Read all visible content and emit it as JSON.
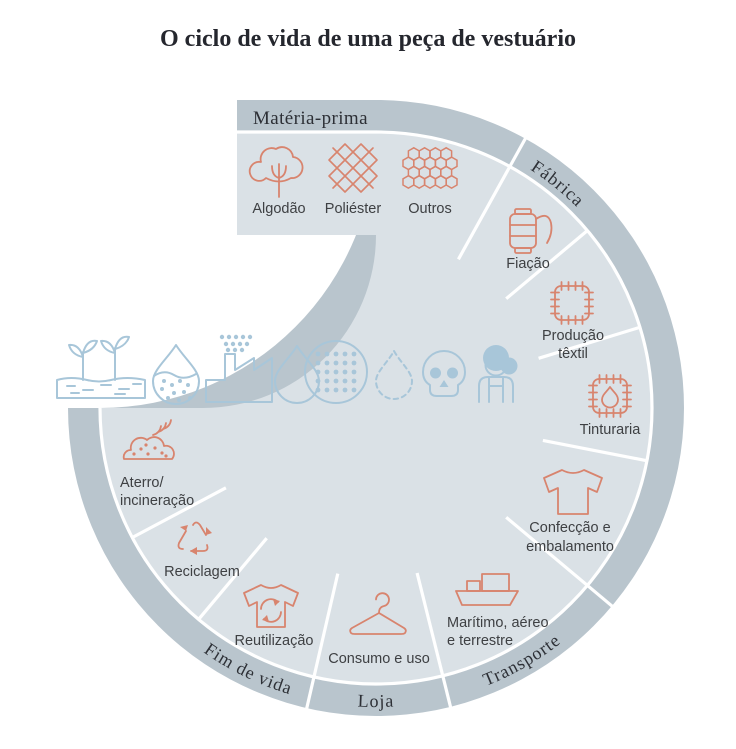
{
  "title": "O ciclo de vida de uma peça de vestuário",
  "colors": {
    "band_outer": "#b9c5cd",
    "band_inner": "#dae1e6",
    "accent_salmon": "#d8846e",
    "accent_blue": "#a8c6d9",
    "label_text": "#3e4043",
    "heading_text": "#25272e",
    "background": "#ffffff"
  },
  "sections": {
    "materia_prima": {
      "label": "Matéria-prima",
      "items": [
        {
          "label": "Algodão",
          "icon": "cotton-icon"
        },
        {
          "label": "Poliéster",
          "icon": "polyester-weave-icon"
        },
        {
          "label": "Outros",
          "icon": "honeycomb-icon"
        }
      ]
    },
    "fabrica": {
      "label": "Fábrica",
      "items": [
        {
          "label": "Fiação",
          "icon": "thread-spool-icon"
        },
        {
          "label": "Produção têxtil",
          "lines": [
            "Produção",
            "têxtil"
          ],
          "icon": "fabric-swatch-icon"
        },
        {
          "label": "Tinturaria",
          "icon": "dye-swatch-icon"
        },
        {
          "label": "Confecção e embalamento",
          "lines": [
            "Confecção e",
            "embalamento"
          ],
          "icon": "tshirt-icon"
        }
      ]
    },
    "transporte": {
      "label": "Transporte",
      "items": [
        {
          "label": "Marítimo, aéreo e terrestre",
          "lines": [
            "Marítimo, aéreo",
            "e terrestre"
          ],
          "icon": "cargo-ship-icon"
        }
      ]
    },
    "loja": {
      "label": "Loja",
      "items": [
        {
          "label": "Consumo e uso",
          "icon": "hanger-icon"
        }
      ]
    },
    "fim_de_vida": {
      "label": "Fim de vida",
      "items": [
        {
          "label": "Reutilização",
          "icon": "tshirt-reuse-icon"
        },
        {
          "label": "Reciclagem",
          "icon": "recycle-arrows-icon"
        },
        {
          "label": "Aterro/incineração",
          "lines": [
            "Aterro/",
            "incineração"
          ],
          "icon": "landfill-smoke-icon"
        }
      ]
    }
  },
  "center_icons": [
    "sprouts-soil-icon",
    "polluted-drop-icon",
    "factory-emissions-icon",
    "water-drop-icon",
    "microfibers-circle-icon",
    "dashed-drop-icon",
    "skull-icon",
    "worker-icon"
  ]
}
